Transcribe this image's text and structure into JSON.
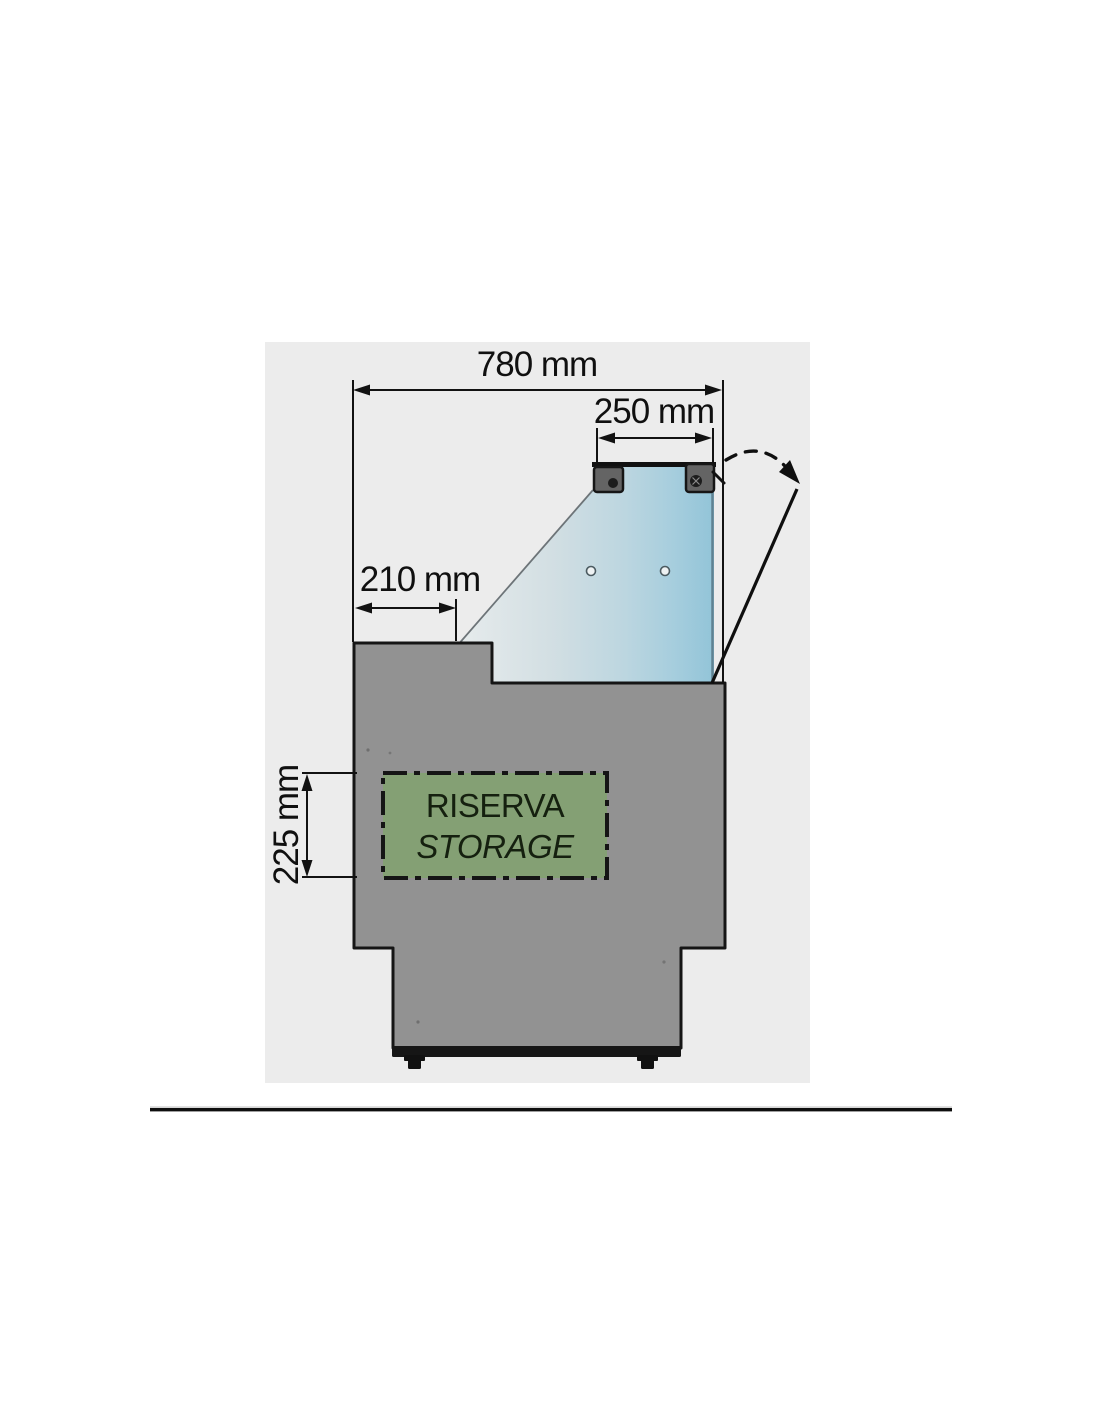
{
  "diagram": {
    "description": "Side cross-section technical drawing of a refrigerated display counter with lift-up glass lid",
    "panel_bg": "#ececec",
    "dimensions": {
      "total_width": "780 mm",
      "lid_width": "250 mm",
      "front_ledge_depth": "210 mm",
      "storage_height": "225 mm"
    },
    "storage_box": {
      "line1": "RISERVA",
      "line2": "STORAGE",
      "fill": "#84a074"
    },
    "colors": {
      "body_gray": "#929292",
      "outline_black": "#151515",
      "glass_light": "#e6ebec",
      "glass_blue": "#9ecede",
      "bracket_gray": "#646464"
    }
  }
}
